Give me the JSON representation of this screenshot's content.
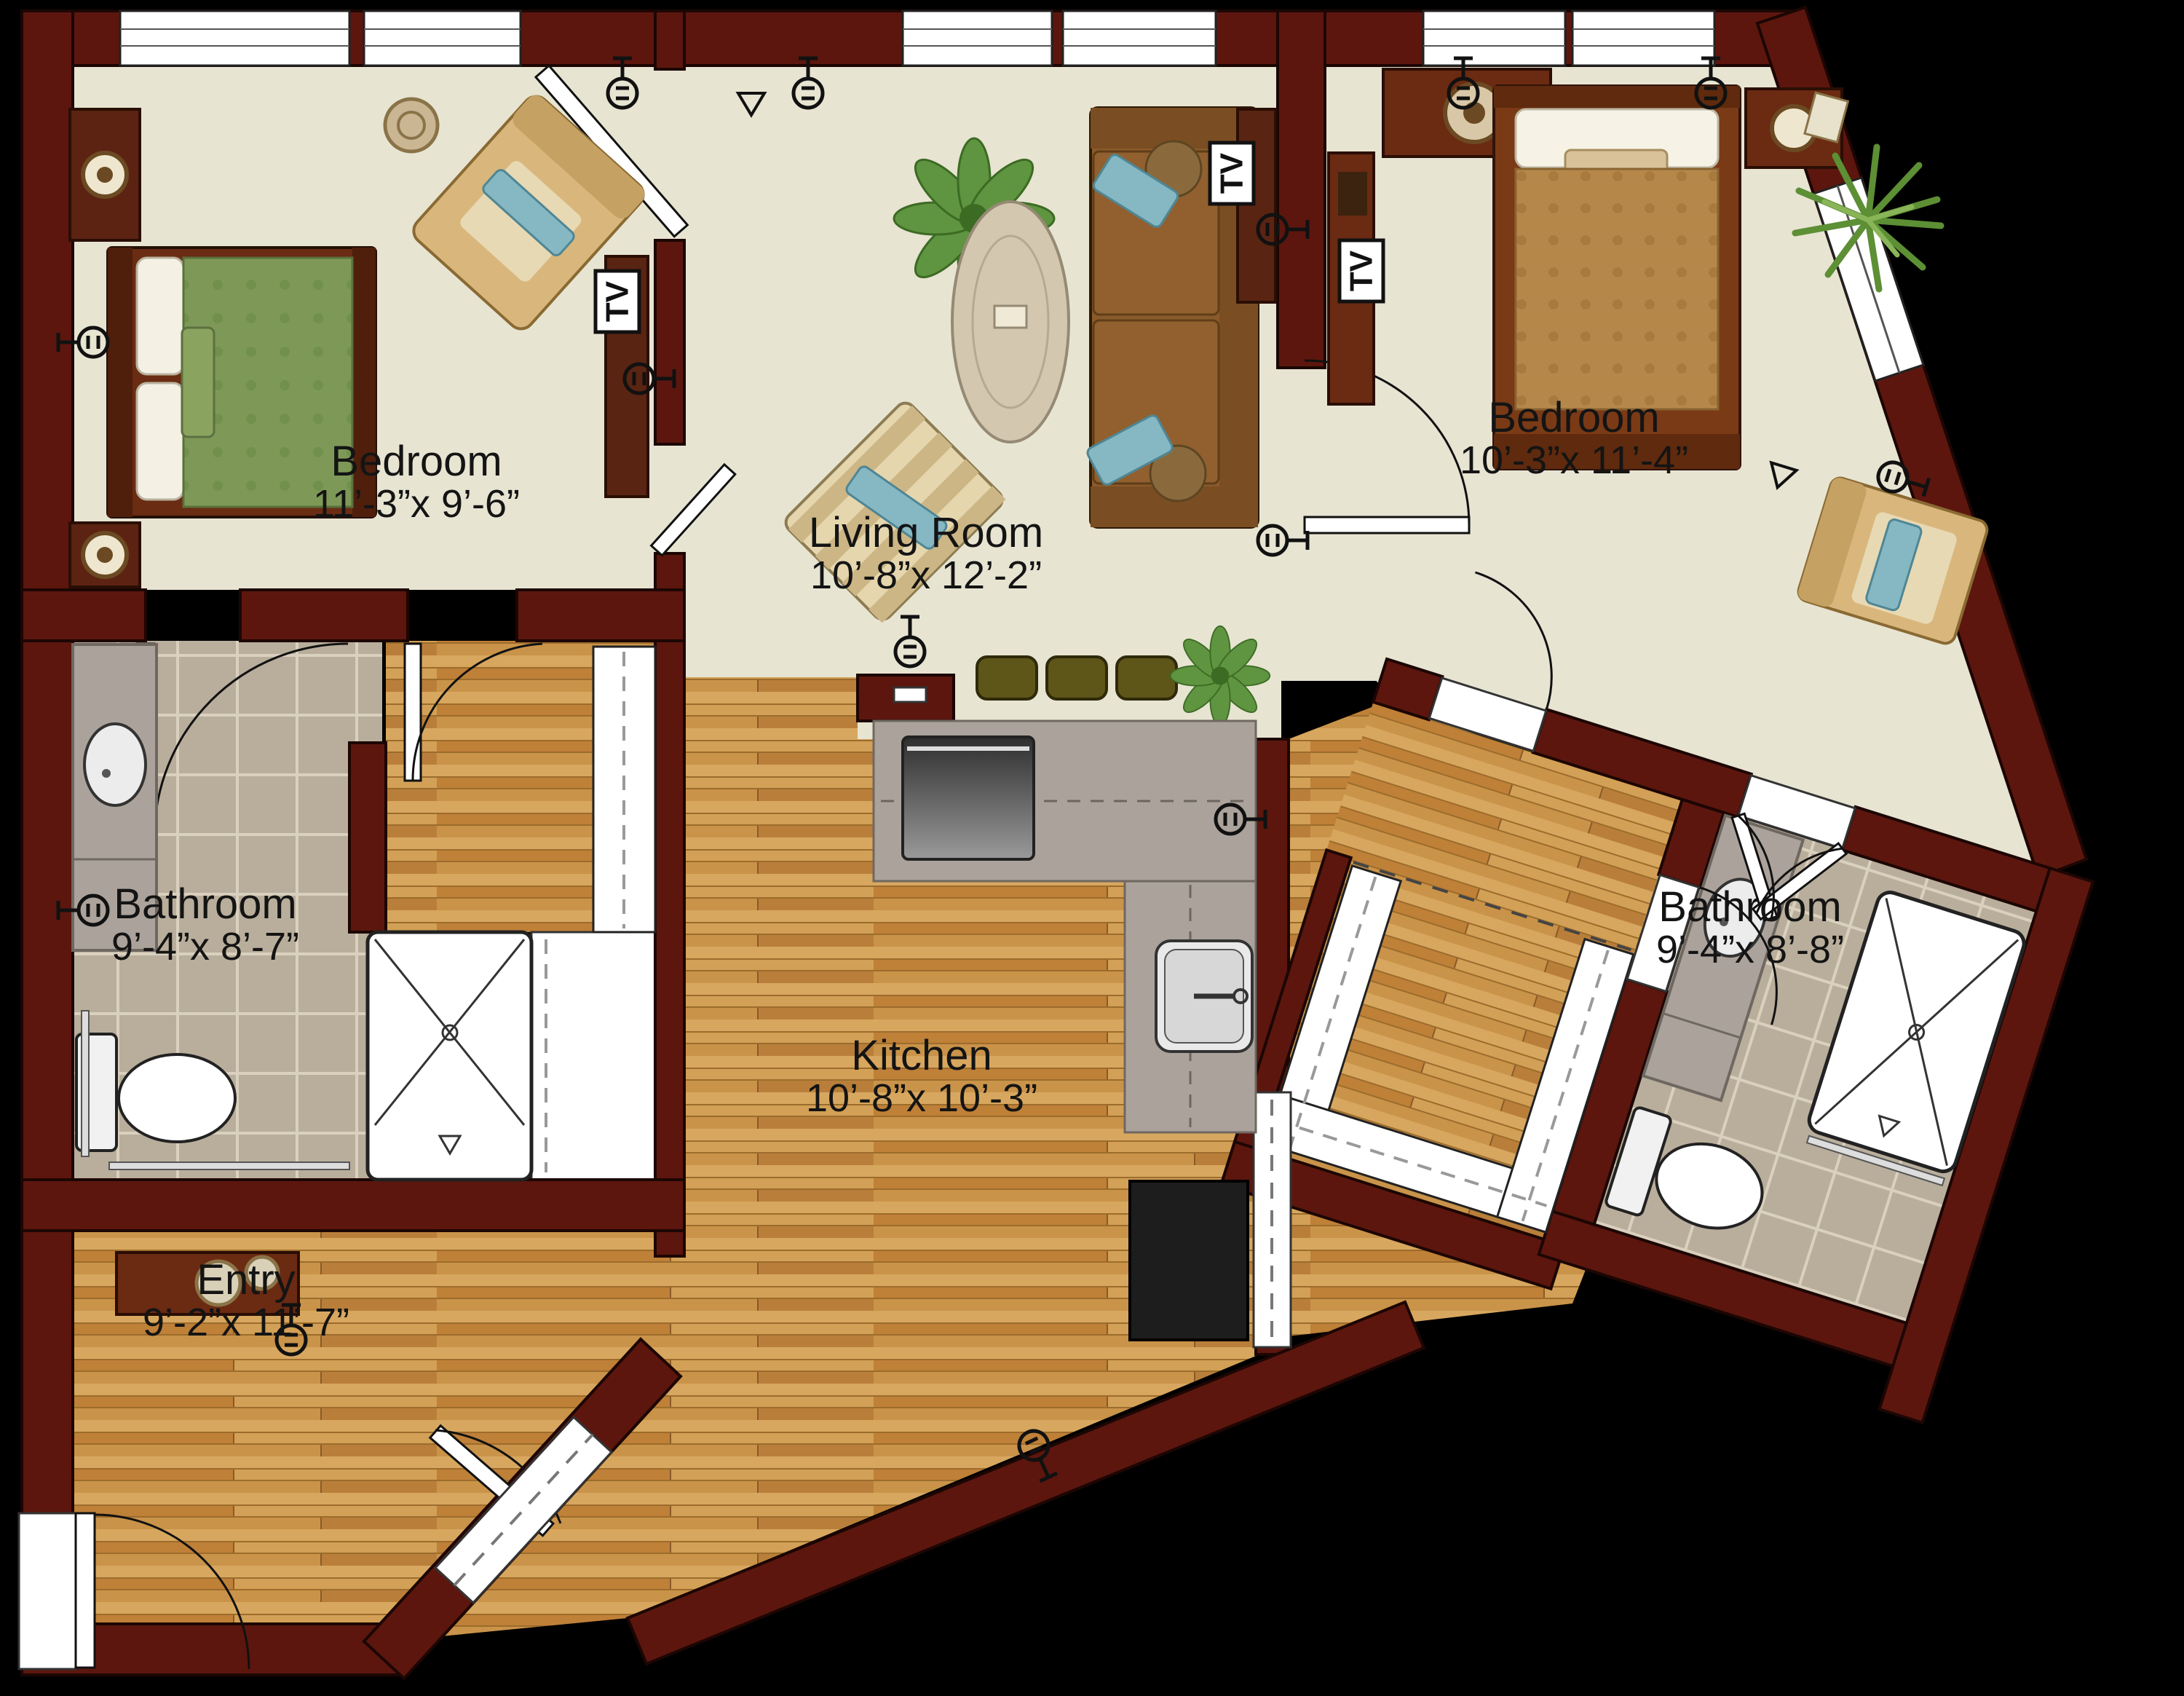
{
  "floor_plan": {
    "title": "Two bedroom apartment floor plan",
    "tv_label": "TV",
    "rooms": [
      {
        "id": "bedroom-1",
        "name": "Bedroom",
        "dimensions": "11’-3”x 9’-6”",
        "fixtures": [
          "queen-bed",
          "nightstand",
          "table-lamp",
          "armchair",
          "tv-cabinet",
          "windows"
        ]
      },
      {
        "id": "living-room",
        "name": "Living Room",
        "dimensions": "10’-8”x 12’-2”",
        "fixtures": [
          "sofa",
          "throw-pillows",
          "oval-coffee-table",
          "striped-armchair",
          "potted-plant",
          "tv-cabinet",
          "bar-stools",
          "windows"
        ]
      },
      {
        "id": "bedroom-2",
        "name": "Bedroom",
        "dimensions": "10’-3”x 11’-4”",
        "fixtures": [
          "bed",
          "nightstand",
          "table-lamp",
          "dresser",
          "armchair",
          "potted-plant",
          "window"
        ]
      },
      {
        "id": "bathroom-1",
        "name": "Bathroom",
        "dimensions": "9’-4”x 8’-7”",
        "fixtures": [
          "vanity-sink",
          "toilet",
          "roll-in-shower",
          "grab-bars",
          "walk-in-closet-shelving"
        ]
      },
      {
        "id": "bathroom-2",
        "name": "Bathroom",
        "dimensions": "9’-4”x 8’-8”",
        "fixtures": [
          "vanity-sink",
          "toilet",
          "roll-in-shower",
          "grab-bar",
          "closet-shelving"
        ]
      },
      {
        "id": "kitchen",
        "name": "Kitchen",
        "dimensions": "10’-8”x 10’-3”",
        "fixtures": [
          "l-shaped-counter",
          "range",
          "kitchen-sink",
          "refrigerator",
          "upper-cabinets-dashed",
          "pass-through"
        ]
      },
      {
        "id": "entry",
        "name": "Entry",
        "dimensions": "9’-2”x 11’-7”",
        "fixtures": [
          "console-table",
          "entry-door",
          "coat-closet-door"
        ]
      }
    ],
    "palette": {
      "background": "#000000",
      "wall": "#5c160e",
      "floor_cream": "#e7e4d2",
      "floor_wood": "#ca9148",
      "floor_tile": "#b9ae9c",
      "counter_gray": "#aba39b",
      "bed1_quilt": "#7e9957",
      "bed2_quilt": "#b5884a",
      "sofa_brown": "#8a5a2b",
      "accent_teal": "#86b8c4",
      "fixture_white": "#ffffff"
    }
  }
}
